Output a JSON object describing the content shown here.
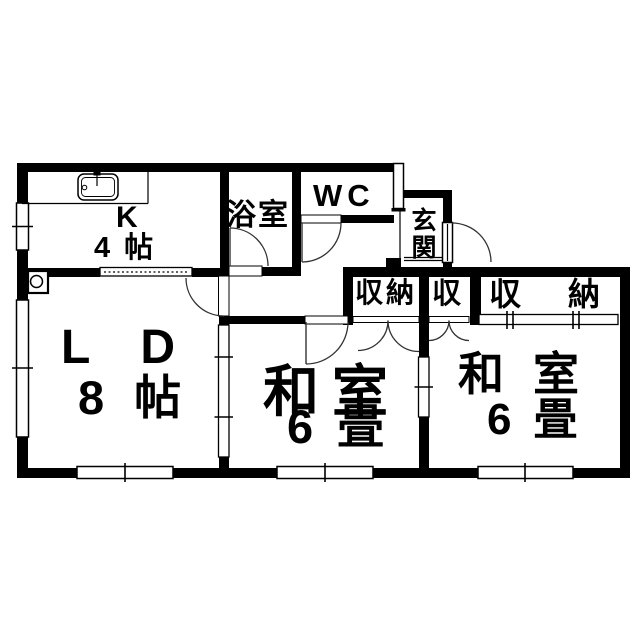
{
  "colors": {
    "wall": "#000000",
    "background": "#ffffff",
    "line": "#333333"
  },
  "rooms": {
    "kitchen": {
      "name": "K",
      "size": "4帖"
    },
    "bathroom": {
      "name": "浴室"
    },
    "toilet": {
      "name": "WC"
    },
    "entrance": {
      "name": "玄関"
    },
    "living_dining": {
      "name": "LD",
      "size": "8帖"
    },
    "japanese_room_1": {
      "name": "和室",
      "size": "6畳"
    },
    "japanese_room_2": {
      "name": "和室",
      "size": "6畳"
    },
    "closet_1": {
      "name": "収納"
    },
    "closet_2": {
      "name": "収"
    },
    "closet_3": {
      "name": "収納"
    }
  }
}
